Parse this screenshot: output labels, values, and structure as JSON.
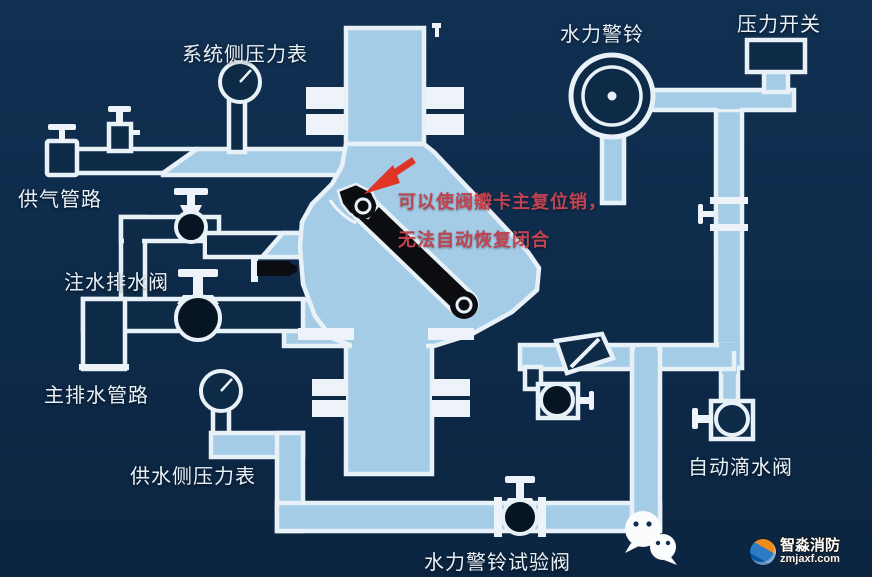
{
  "scene": {
    "background_color": "#0e2b49",
    "pipe_fill_color": "#a4cce7",
    "outline_color": "#e9f1f8",
    "clapper_color": "#0b0d10",
    "annotation_color": "#c04351",
    "label_color": "#e9f1f8"
  },
  "labels": {
    "system_gauge": "系统侧压力表",
    "air_supply": "供气管路",
    "injection_drain_valve": "注水排水阀",
    "main_drain": "主排水管路",
    "supply_gauge": "供水侧压力表",
    "alarm_bell": "水力警铃",
    "pressure_switch": "压力开关",
    "auto_drip_valve": "自动滴水阀",
    "alarm_test_valve": "水力警铃试验阀"
  },
  "annotation": {
    "line1": "可以使阀瓣卡主复位销，",
    "line2": "无法自动恢复闭合"
  },
  "watermark": {
    "brand": "智淼消防",
    "url": "zmjaxf.com"
  },
  "icons": {
    "wechat": "wechat-share-icon",
    "arrow": "red-pointer-arrow"
  }
}
